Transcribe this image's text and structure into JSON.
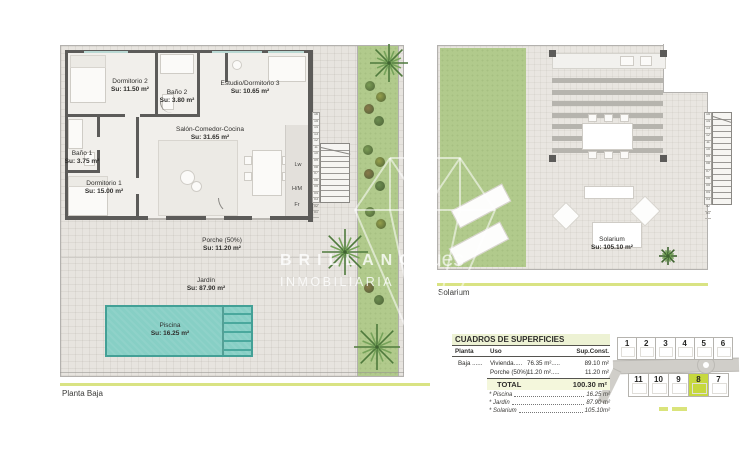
{
  "plans": {
    "planta_baja": {
      "section_label": "Planta Baja",
      "rooms": [
        {
          "name": "Dormitorio 2",
          "area": "Su: 11.50 m²"
        },
        {
          "name": "Baño 2",
          "area": "Su: 3.80 m²"
        },
        {
          "name": "Estudio/Dormitorio 3",
          "area": "Su: 10.65 m²"
        },
        {
          "name": "Salón-Comedor-Cocina",
          "area": "Su: 31.65 m²"
        },
        {
          "name": "Baño 1",
          "area": "Su: 3.75 m²"
        },
        {
          "name": "Dormitorio 1",
          "area": "Su: 15.00 m²"
        },
        {
          "name": "Porche (50%)",
          "area": "Su: 11.20 m²"
        },
        {
          "name": "Jardín",
          "area": "Su: 87.90 m²"
        },
        {
          "name": "Piscina",
          "area": "Su: 16.25 m²"
        }
      ],
      "appliance_labels": [
        "Lw",
        "H/M",
        "Fr"
      ],
      "stair_step_numbers": [
        "16",
        "15",
        "14",
        "13",
        "12",
        "11",
        "10",
        "09",
        "08",
        "07",
        "06",
        "05",
        "04",
        "03",
        "02",
        "01"
      ]
    },
    "solarium": {
      "section_label": "Solarium",
      "rooms": [
        {
          "name": "Solarium",
          "area": "Su: 105.10 m²"
        }
      ],
      "stair_step_numbers": [
        "15",
        "14",
        "13",
        "12",
        "11",
        "10",
        "09",
        "08",
        "07",
        "06",
        "05",
        "04",
        "03",
        "02",
        "01"
      ]
    }
  },
  "watermark": {
    "line1": "BRILLANCE",
    "line2": "INMOBILIARIA",
    "fragment": "ues"
  },
  "surface_table": {
    "title": "CUADROS DE SUPERFICIES",
    "col_planta": "Planta",
    "col_uso": "Uso",
    "col_const": "Sup.Const.",
    "rows": [
      {
        "planta": "Baja ......",
        "uso": "Vivienda.....",
        "util": "76.35 m².....",
        "const": "89.10 m²"
      },
      {
        "planta": "",
        "uso": "Porche (50%)",
        "util": "11.20 m².....",
        "const": "11.20 m²"
      }
    ],
    "total_label": "TOTAL",
    "total_value": "100.30 m²",
    "footnotes": [
      {
        "label": "* Piscina",
        "value": "16.25 m²"
      },
      {
        "label": "* Jardín",
        "value": "87.90 m²"
      },
      {
        "label": "* Solarium",
        "value": "105.10m²"
      }
    ]
  },
  "plot_map": {
    "top_row": [
      "1",
      "2",
      "3",
      "4",
      "5",
      "6"
    ],
    "bottom_row": [
      "11",
      "10",
      "9",
      "8",
      "7"
    ],
    "highlighted_plot": "8"
  },
  "colors": {
    "accent_green": "#d9e383",
    "highlight_plot": "#c6d83f",
    "grass": "#b1ca8c",
    "pool": "#87cfc5",
    "wall": "#5c5b59"
  }
}
